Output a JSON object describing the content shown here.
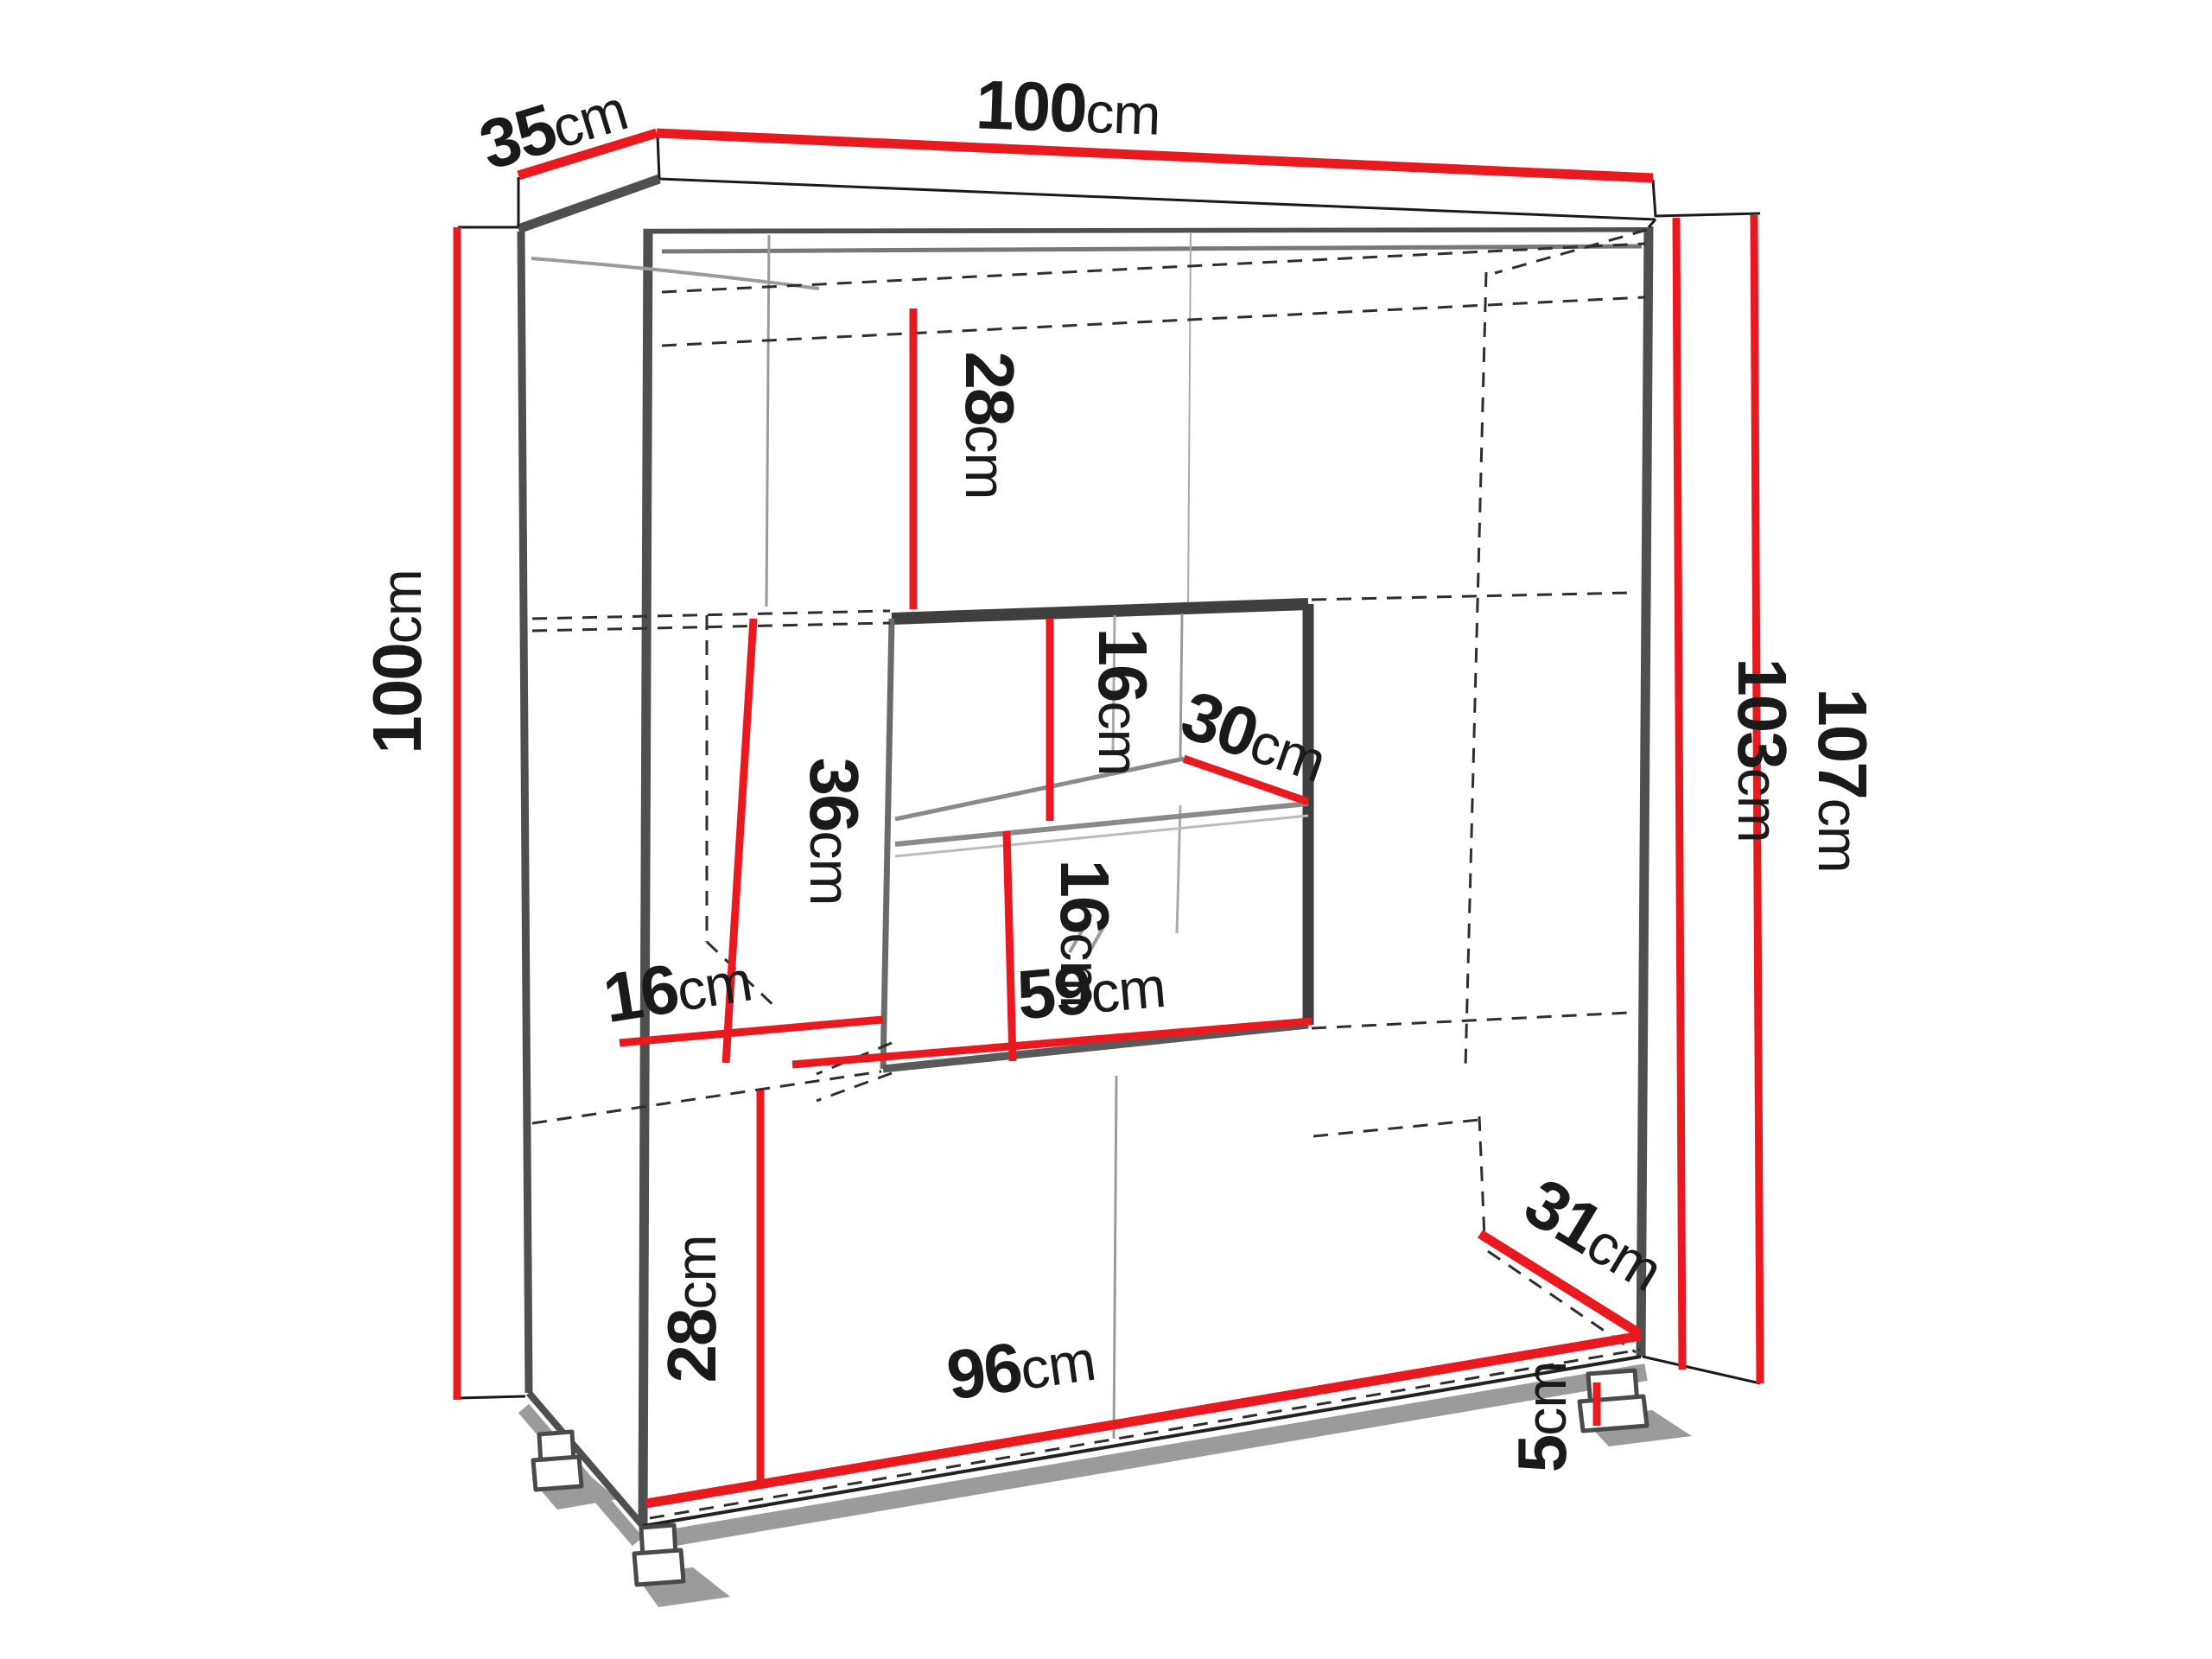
{
  "title": "Cabinet dimension diagram",
  "unit": "cm",
  "colors": {
    "dimension_line": "#e8191f",
    "outline": "#4f4f4f",
    "hidden_edge": "#2e2e2e",
    "label_text": "#1a1a1a",
    "background": "#ffffff"
  },
  "dimensions": {
    "depth_top": {
      "value": "35",
      "unit": "cm"
    },
    "width_top": {
      "value": "100",
      "unit": "cm"
    },
    "height_left": {
      "value": "100",
      "unit": "cm"
    },
    "upper_section": {
      "value": "28",
      "unit": "cm"
    },
    "display_upper": {
      "value": "16",
      "unit": "cm"
    },
    "shelf_depth": {
      "value": "30",
      "unit": "cm"
    },
    "display_side": {
      "value": "36",
      "unit": "cm"
    },
    "display_lower": {
      "value": "16",
      "unit": "cm"
    },
    "side_shelf_depth": {
      "value": "16",
      "unit": "cm"
    },
    "display_width": {
      "value": "59",
      "unit": "cm"
    },
    "lower_section": {
      "value": "28",
      "unit": "cm"
    },
    "bottom_width": {
      "value": "96",
      "unit": "cm"
    },
    "bottom_depth": {
      "value": "31",
      "unit": "cm"
    },
    "leg_height": {
      "value": "5",
      "unit": "cm"
    },
    "height_inner": {
      "value": "103",
      "unit": "cm"
    },
    "height_total": {
      "value": "107",
      "unit": "cm"
    }
  }
}
